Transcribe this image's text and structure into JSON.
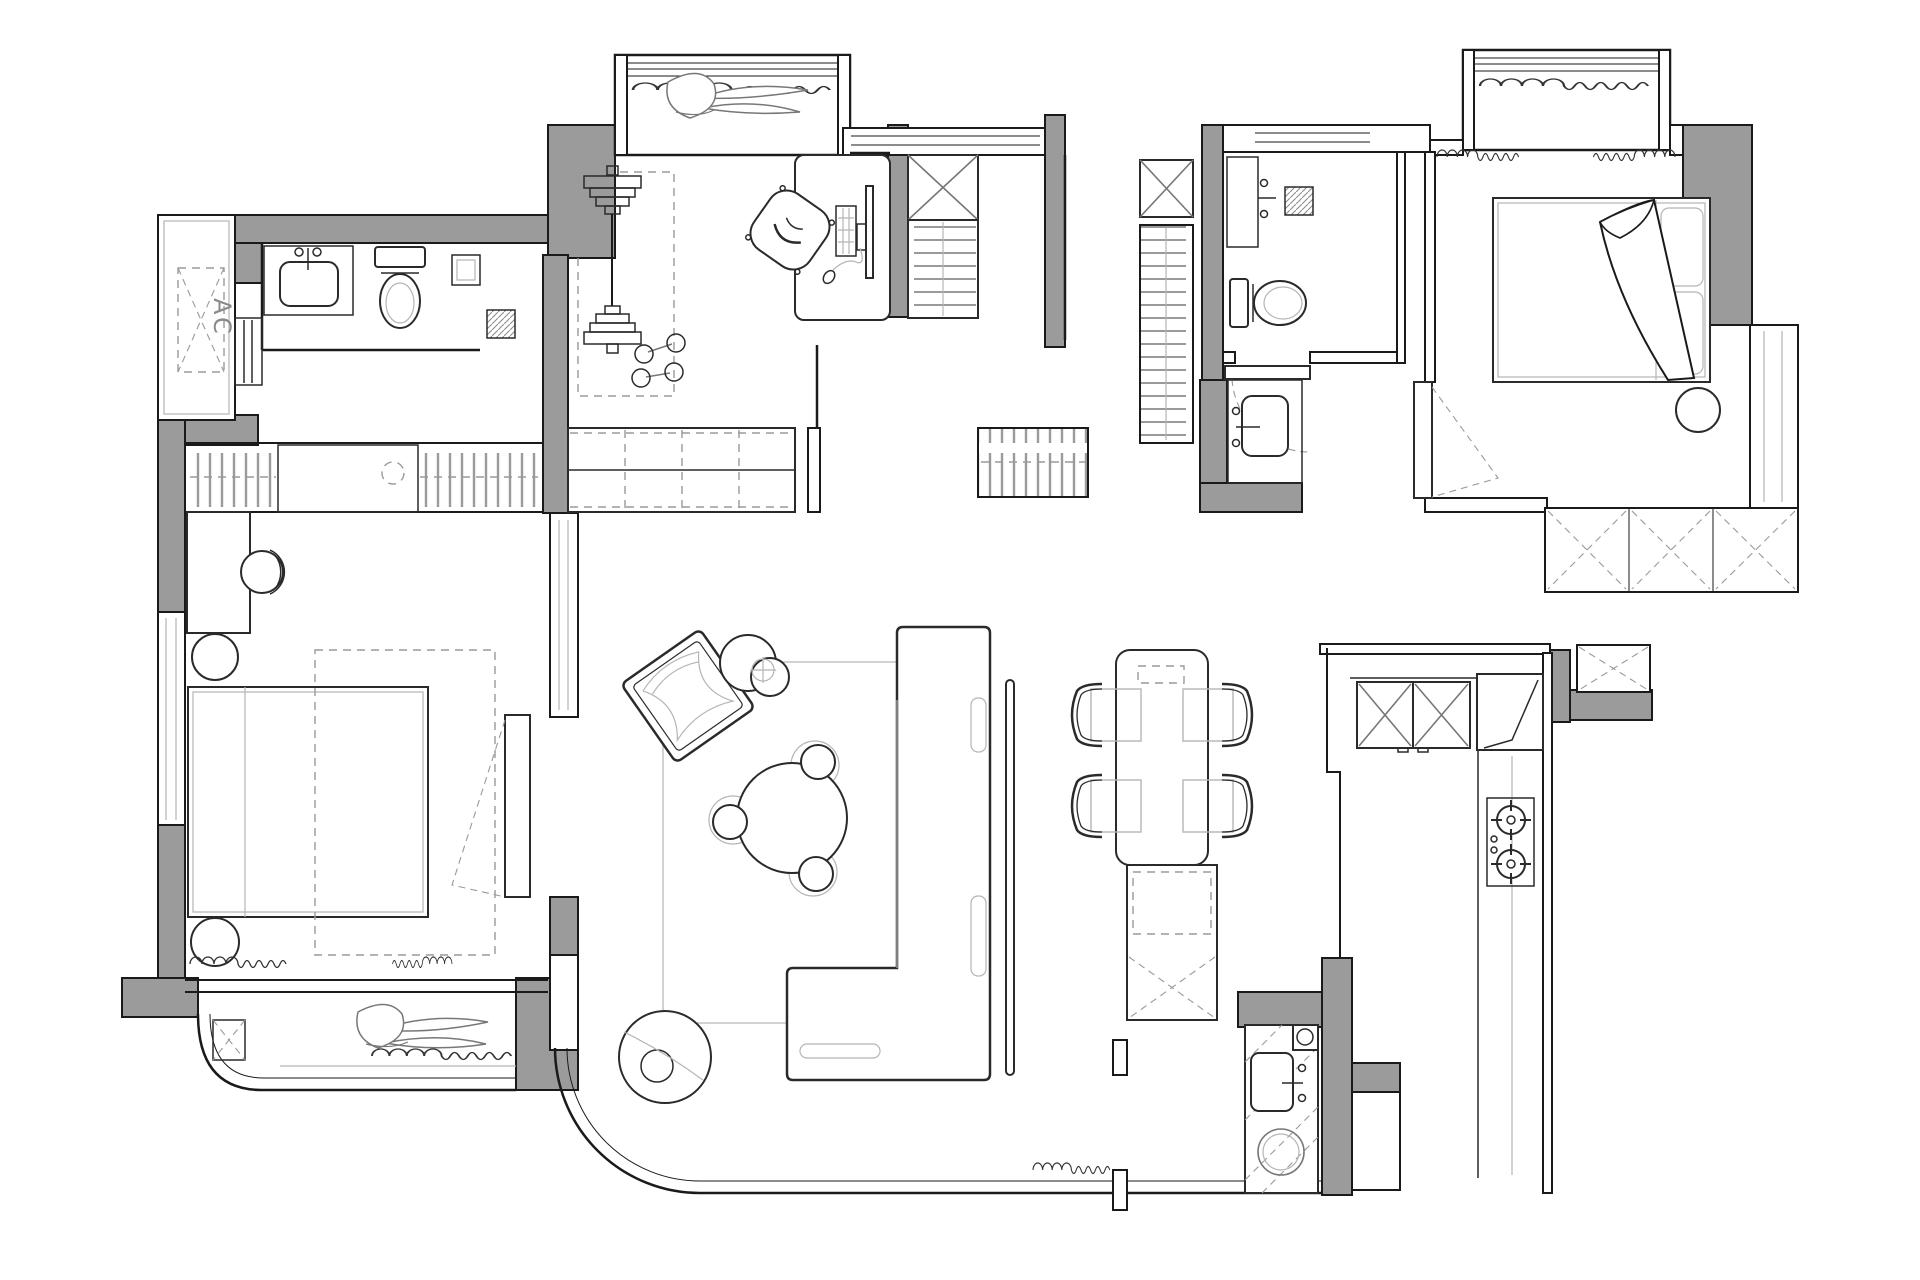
{
  "canvas": {
    "width": 1920,
    "height": 1280
  },
  "labels": {
    "ac_unit": "AC"
  },
  "colors": {
    "bg": "#ffffff",
    "wall_fill": "#9b9b9b",
    "wall_stroke": "#1a1a1a",
    "furniture_stroke": "#2a2a2a",
    "light_detail": "#b5b5b5",
    "dash_detail": "#9a9a9a"
  },
  "icons": {
    "ac-unit-icon": "dashed rectangle with X and rotated AC text",
    "toilet-icon": "tank rectangle with oval bowl",
    "sink-icon": "rounded basin with faucet dots",
    "shower-drain-icon": "hatched square",
    "barbell-icon": "bar with stacked plates",
    "dumbbells-icon": "two small bars with round ends",
    "desk-icon": "rounded rectangle",
    "monitor-icon": "thin vertical rectangle",
    "keyboard-icon": "small gridded rectangle",
    "office-chair-icon": "rotated rounded square with curved back",
    "wardrobe-x-icon": "rectangle with diagonal cross",
    "closet-rail-icon": "rectangle with vertical ticks and center rail",
    "shelf-unit-icon": "rectangle with horizontal shelf lines",
    "bed-icon": "rectangle with inner mattress line",
    "pillow-icon": "rounded rectangle",
    "blanket-icon": "folded triangular throw",
    "nightstand-icon": "circle",
    "stool-icon": "circle",
    "plant-icon": "long pointed leaves",
    "curtain-icon": "wavy scallop line",
    "door-icon": "leaf rectangle with dashed swing",
    "dining-table-icon": "long rounded rectangle",
    "dining-chair-icon": "arc-back chair",
    "sideboard-icon": "rectangle with dashed inset and cross hatch",
    "sofa-icon": "L-shaped outline with cushions",
    "coffee-table-icon": "large circle with three stools",
    "side-table-icon": "two overlapping circles",
    "floor-lamp-icon": "circle with inner circle",
    "accent-chair-icon": "rotated square with cushion curves",
    "stove-icon": "rectangle with two cross-tick burners",
    "washing-machine-icon": "circle in hatched square",
    "water-heater-icon": "small square with circle",
    "kitchen-cabinet-icon": "boxes with X doors",
    "window-icon": "parallel lines"
  }
}
